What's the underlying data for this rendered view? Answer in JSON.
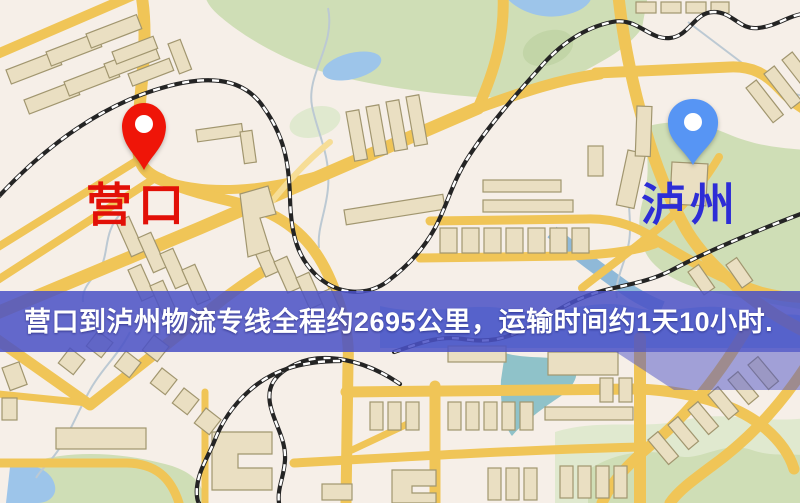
{
  "route": {
    "origin": {
      "label": "营口",
      "label_color": "#e21007",
      "pin_color": "#ef1508"
    },
    "destination": {
      "label": "泸州",
      "label_color": "#2d2dd6",
      "pin_color": "#5795f4"
    },
    "banner": {
      "text": "营口到泸州物流专线全程约2695公里，运输时间约1天10小时.",
      "background": "#4b51c6",
      "text_color": "#ffffff",
      "distance_km": "2695",
      "duration": "1天10小时"
    }
  },
  "map_palette": {
    "land": "#f6efe8",
    "road": "#f0c557",
    "road-light": "#f6dd96",
    "park": "#cfdeb6",
    "water": "#9dc5ea",
    "building": "#eadfc2",
    "building-stroke": "#a1966f",
    "railway": "#242424"
  }
}
